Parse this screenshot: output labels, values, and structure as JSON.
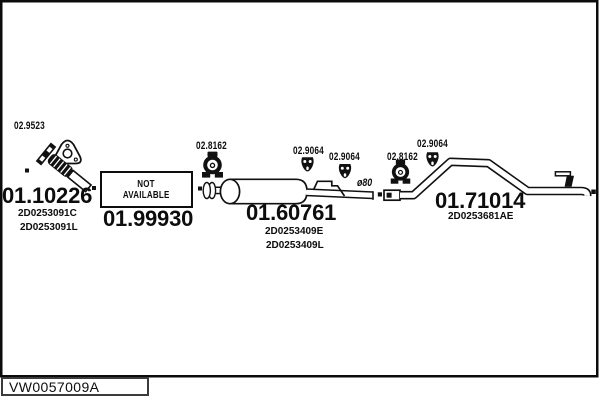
{
  "footer": {
    "code": "VW0057009A"
  },
  "fittings": {
    "gasket_label": "02.9523",
    "clamp_label": "02.8162",
    "hanger_label": "02.9064"
  },
  "parts": {
    "downpipe": {
      "number": "01.10226",
      "oe": [
        "2D0253091C",
        "2D0253091L"
      ]
    },
    "front_pipe": {
      "number": "01.99930",
      "status_lines": [
        "NOT",
        "AVAILABLE"
      ]
    },
    "centre_muffler": {
      "number": "01.60761",
      "oe": [
        "2D0253409E",
        "2D0253409L"
      ],
      "pipe_diameter": "ø80"
    },
    "tail_pipe": {
      "number": "01.71014",
      "oe": [
        "2D0253681AE"
      ]
    }
  }
}
